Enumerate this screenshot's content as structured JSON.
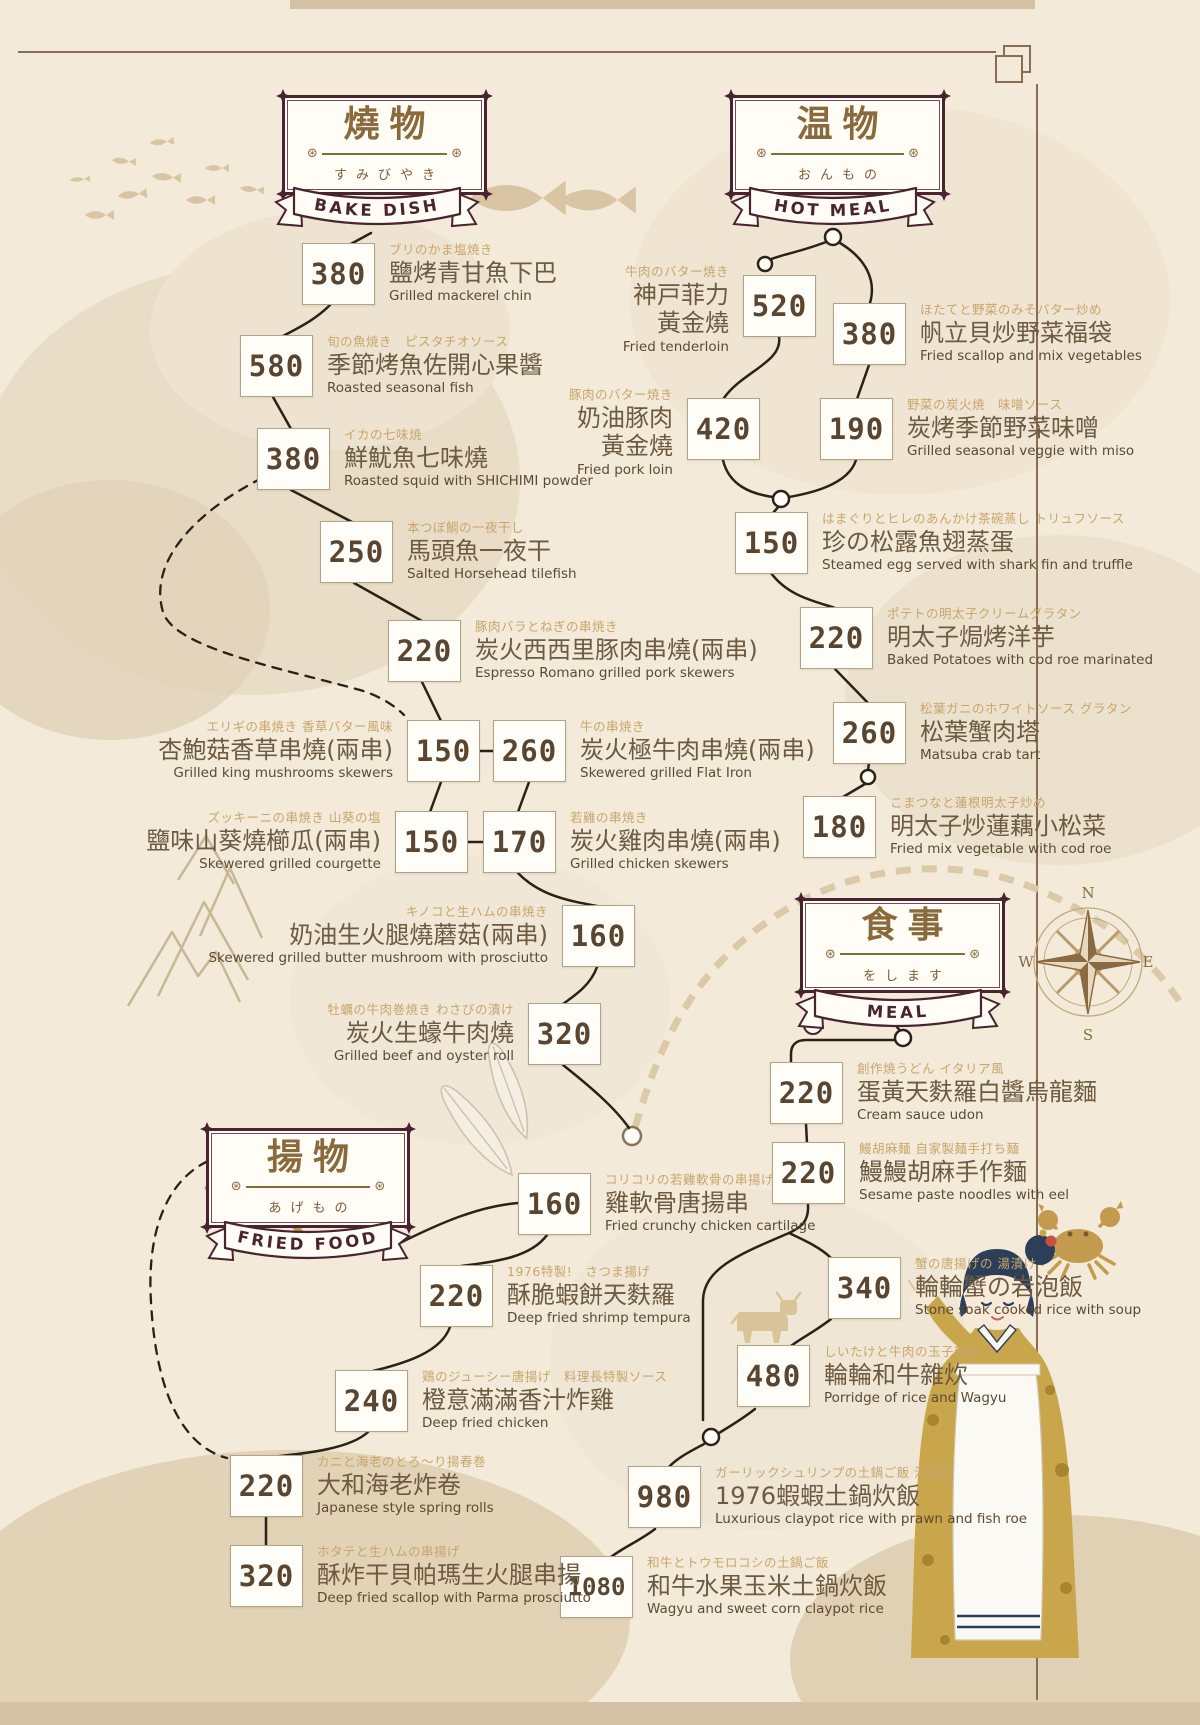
{
  "sections": [
    {
      "id": "bake",
      "title": "燒物",
      "kana": "すみびやき",
      "banner": "BAKE DISH",
      "items": [
        {
          "price": "380",
          "jp": "ブリのかま塩焼き",
          "name": "鹽烤青甘魚下巴",
          "en": "Grilled mackerel chin"
        },
        {
          "price": "580",
          "jp": "旬の魚焼き　ピスタチオソース",
          "name": "季節烤魚佐開心果醬",
          "en": "Roasted seasonal fish"
        },
        {
          "price": "380",
          "jp": "イカの七味焼",
          "name": "鮮魷魚七味燒",
          "en": "Roasted squid with SHICHIMI powder"
        },
        {
          "price": "250",
          "jp": "本つぼ鯛の一夜干し",
          "name": "馬頭魚一夜干",
          "en": "Salted Horsehead tilefish"
        },
        {
          "price": "220",
          "jp": "豚肉バラとねぎの串焼き",
          "name": "炭火西西里豚肉串燒(兩串)",
          "en": "Espresso Romano grilled pork skewers"
        },
        {
          "price": "150",
          "jp": "エリギの串焼き 香草バター風味",
          "name": "杏鮑菇香草串燒(兩串)",
          "en": "Grilled king mushrooms skewers"
        },
        {
          "price": "260",
          "jp": "牛の串焼き",
          "name": "炭火極牛肉串燒(兩串)",
          "en": "Skewered grilled Flat Iron"
        },
        {
          "price": "150",
          "jp": "ズッキーニの串焼き 山葵の塩",
          "name": "鹽味山葵燒櫛瓜(兩串)",
          "en": "Skewered grilled courgette"
        },
        {
          "price": "170",
          "jp": "若雞の串焼き",
          "name": "炭火雞肉串燒(兩串)",
          "en": "Grilled chicken skewers"
        },
        {
          "price": "160",
          "jp": "キノコと生ハムの串焼き",
          "name": "奶油生火腿燒蘑菇(兩串)",
          "en": "Skewered grilled butter mushroom with prosciutto"
        },
        {
          "price": "320",
          "jp": "牡蠣の牛肉巻焼き わさびの漬け",
          "name": "炭火生蠔牛肉燒",
          "en": "Grilled beef and oyster roll"
        }
      ]
    },
    {
      "id": "hot",
      "title": "温物",
      "kana": "おんもの",
      "banner": "HOT MEAL",
      "items": [
        {
          "price": "520",
          "jp": "牛肉のバター焼き",
          "name": "神戸菲力\n黃金燒",
          "en": "Fried tenderloin"
        },
        {
          "price": "380",
          "jp": "ほたてと野菜のみそバター炒め",
          "name": "帆立貝炒野菜福袋",
          "en": "Fried scallop and mix vegetables"
        },
        {
          "price": "420",
          "jp": "豚肉のバター焼き",
          "name": "奶油豚肉\n黃金燒",
          "en": "Fried pork loin"
        },
        {
          "price": "190",
          "jp": "野菜の炭火焼　味噌ソース",
          "name": "炭烤季節野菜味噌",
          "en": "Grilled seasonal veggie with miso"
        },
        {
          "price": "150",
          "jp": "はまぐりとヒレのあんかけ茶碗蒸し トリュフソース",
          "name": "珍の松露魚翅蒸蛋",
          "en": "Steamed egg served with shark fin and truffle"
        },
        {
          "price": "220",
          "jp": "ポテトの明太子クリームグラタン",
          "name": "明太子焗烤洋芋",
          "en": "Baked Potatoes with cod roe marinated"
        },
        {
          "price": "260",
          "jp": "松葉ガニのホワイトソース グラタン",
          "name": "松葉蟹肉塔",
          "en": "Matsuba crab tart"
        },
        {
          "price": "180",
          "jp": "こまつなと蓮根明太子炒め",
          "name": "明太子炒蓮藕小松菜",
          "en": "Fried mix vegetable with cod roe"
        }
      ]
    },
    {
      "id": "meal",
      "title": "食事",
      "kana": "をします",
      "banner": "MEAL",
      "items": [
        {
          "price": "220",
          "jp": "創作焼うどん イタリア風",
          "name": "蛋黃天麩羅白醬烏龍麵",
          "en": "Cream sauce udon"
        },
        {
          "price": "220",
          "jp": "鰻胡麻麺 自家製麺手打ち麺",
          "name": "鰻鰻胡麻手作麵",
          "en": "Sesame paste noodles with eel"
        },
        {
          "price": "340",
          "jp": "蟹の唐揚げの 湯漬け",
          "name": "輪輪蟹の岩泡飯",
          "en": "Stone soak cooked rice with soup"
        },
        {
          "price": "480",
          "jp": "しいたけと牛肉の玉子雑炊",
          "name": "輪輪和牛雜炊",
          "en": "Porridge of rice and Wagyu"
        },
        {
          "price": "980",
          "jp": "ガーリックシュリンプの土鍋ご飯 沖縄風",
          "name": "1976蝦蝦土鍋炊飯",
          "en": "Luxurious claypot rice with prawn and fish roe"
        },
        {
          "price": "1080",
          "jp": "和牛とトウモロコシの土鍋ご飯",
          "name": "和牛水果玉米土鍋炊飯",
          "en": "Wagyu and sweet corn claypot rice"
        }
      ]
    },
    {
      "id": "fried",
      "title": "揚物",
      "kana": "あげもの",
      "banner": "FRIED FOOD",
      "items": [
        {
          "price": "160",
          "jp": "コリコリの若雞軟骨の串揚げ",
          "name": "雞軟骨唐揚串",
          "en": "Fried crunchy chicken cartilage"
        },
        {
          "price": "220",
          "jp": "1976特製!　さつま揚げ",
          "name": "酥脆蝦餅天麩羅",
          "en": "Deep fried shrimp tempura"
        },
        {
          "price": "240",
          "jp": "鶏のジューシー唐揚げ　料理長特製ソース",
          "name": "橙意滿滿香汁炸雞",
          "en": "Deep fried chicken"
        },
        {
          "price": "220",
          "jp": "カニと海老のとろ〜り揚春巻",
          "name": "大和海老炸卷",
          "en": "Japanese style spring rolls"
        },
        {
          "price": "320",
          "jp": "ホタテと生ハムの串揚げ",
          "name": "酥炸干貝帕瑪生火腿串揚",
          "en": "Deep fried scallop with Parma prosciutto"
        }
      ]
    }
  ],
  "compass": {
    "n": "N",
    "e": "E",
    "s": "S",
    "w": "W"
  },
  "colors": {
    "background": "#f3ead9",
    "frame_maroon": "#4a2330",
    "title_gold": "#8a6a3c",
    "subtitle_tan": "#c9a56b",
    "text_brown": "#5d4a33",
    "path_ink": "#2b2118",
    "track_tan": "#dcc9a8"
  }
}
